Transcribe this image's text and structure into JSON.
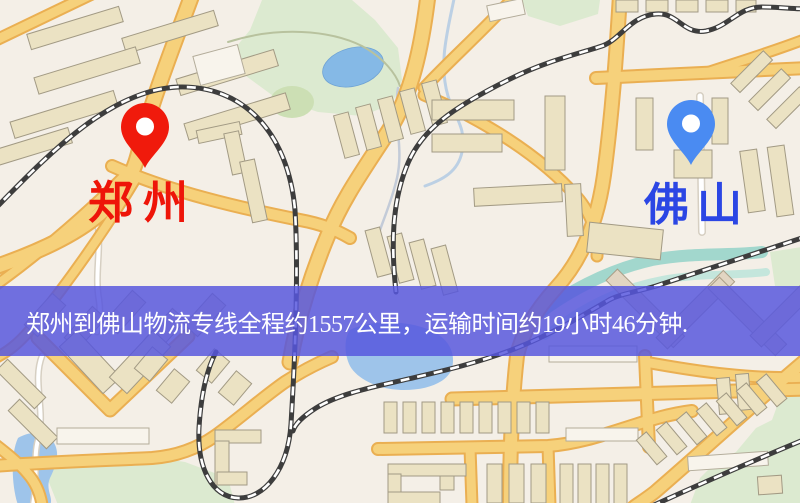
{
  "map": {
    "banner": {
      "text": "郑州到佛山物流专线全程约1557公里，运输时间约19小时46分钟."
    },
    "markers": [
      {
        "id": "origin",
        "label": "郑州",
        "pin_icon": "red-map-pin"
      },
      {
        "id": "destination",
        "label": "佛山",
        "pin_icon": "blue-map-pin"
      }
    ],
    "colors": {
      "land": "#f4efe7",
      "park": "#dcead0",
      "park_dark": "#ccdfb4",
      "water": "#9ec4ea",
      "lake": "#85b9e6",
      "stream_teal": "#93d2c8",
      "road_fill": "#f6d17b",
      "road_casing": "#eaaf52",
      "white_road": "#ffffff",
      "white_road_casing": "#d6cfc2",
      "railway": "#3d3d3d",
      "railway_dash": "#ffffff",
      "building": "#ebe2c3",
      "building_outline": "#a29a84",
      "building_white": "#f8f4ec",
      "banner_bg": "rgba(86,86,222,0.84)",
      "banner_text": "#ffffff",
      "pin_origin": "#f01a0c",
      "pin_origin_label": "#ee1509",
      "pin_destination": "#4a8bf2",
      "pin_destination_label": "#2b46e4"
    }
  }
}
